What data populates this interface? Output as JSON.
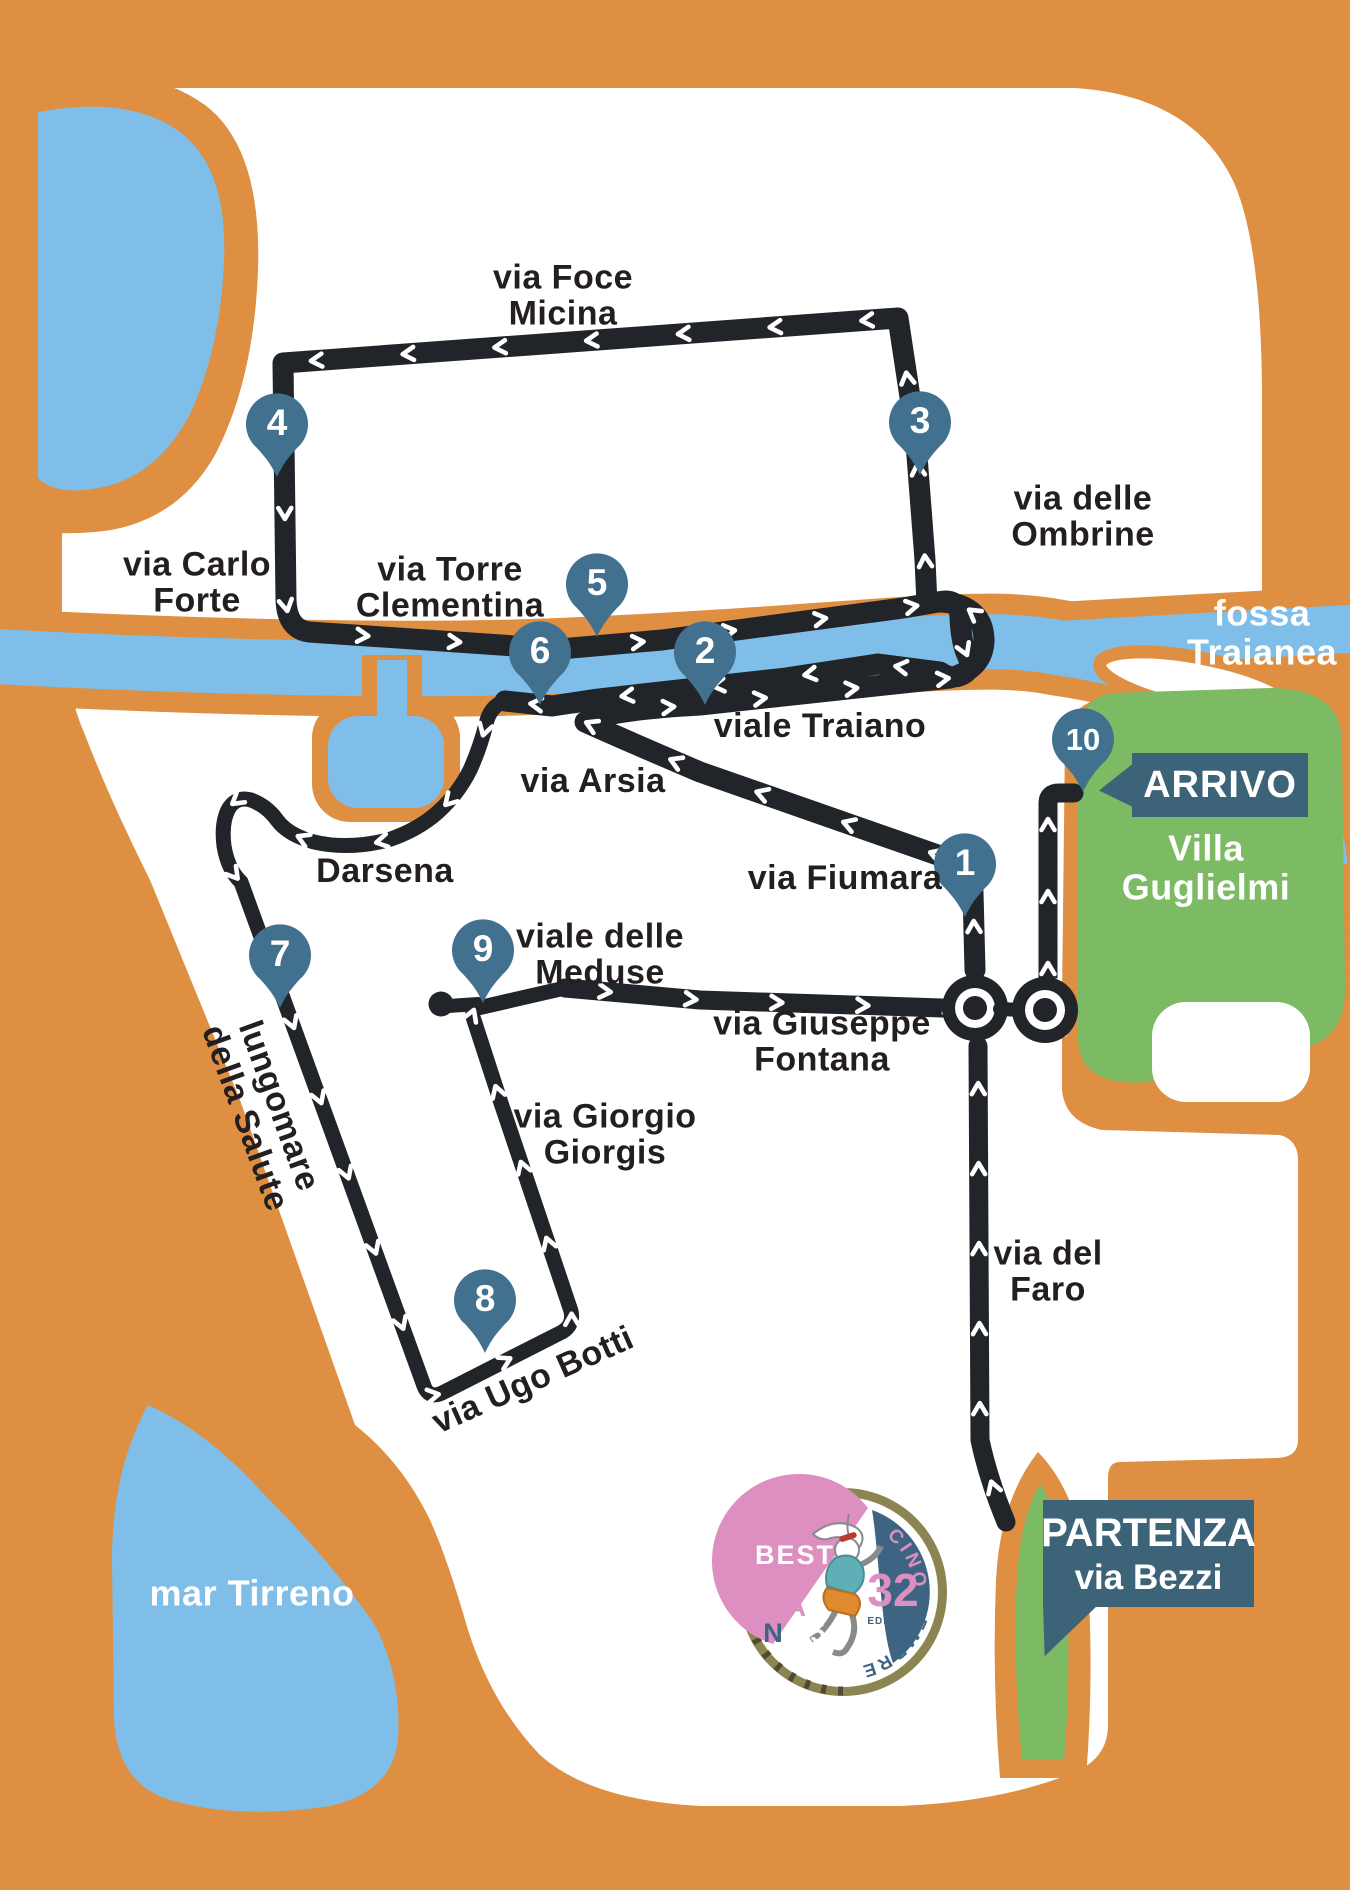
{
  "map": {
    "colors": {
      "orange": "#DE8F41",
      "water": "#7FBEE8",
      "green": "#7CBA63",
      "route": "#212428",
      "pin": "#41718E",
      "box": "#3C6377",
      "ink": "#231F20"
    },
    "labels": {
      "foce_micina": "via Foce\nMicina",
      "ombrine": "via delle Ombrine",
      "carlo_forte": "via Carlo\nForte",
      "torre_clementina": "via Torre\nClementina",
      "traiano": "viale Traiano",
      "arsia": "via Arsia",
      "darsena": "Darsena",
      "fiumara": "via Fiumara",
      "lungomare": "lungomare\ndella Salute",
      "meduse": "viale delle\nMeduse",
      "fontana": "via Giuseppe\nFontana",
      "giorgis": "via Giorgio\nGiorgis",
      "ugo_botti": "via Ugo Botti",
      "faro": "via del\nFaro",
      "mar_tirreno": "mar Tirreno",
      "fossa_traianea": "fossa\nTraianea"
    },
    "markers": [
      {
        "number": "1"
      },
      {
        "number": "2"
      },
      {
        "number": "3"
      },
      {
        "number": "4"
      },
      {
        "number": "5"
      },
      {
        "number": "6"
      },
      {
        "number": "7"
      },
      {
        "number": "8"
      },
      {
        "number": "9"
      },
      {
        "number": "10"
      }
    ],
    "finish": {
      "label": "ARRIVO",
      "area": "Villa\nGuglielmi"
    },
    "start": {
      "label": "PARTENZA",
      "street": "via Bezzi"
    },
    "logo": {
      "best": "BEST",
      "wo": "WO",
      "ma": "MA",
      "n": "N",
      "year": "'25",
      "edition_number": "32",
      "edition_label": "EDIZIONE",
      "top_text": "FIUMICINO",
      "bottom_text": "07 DICEMBRE"
    }
  }
}
